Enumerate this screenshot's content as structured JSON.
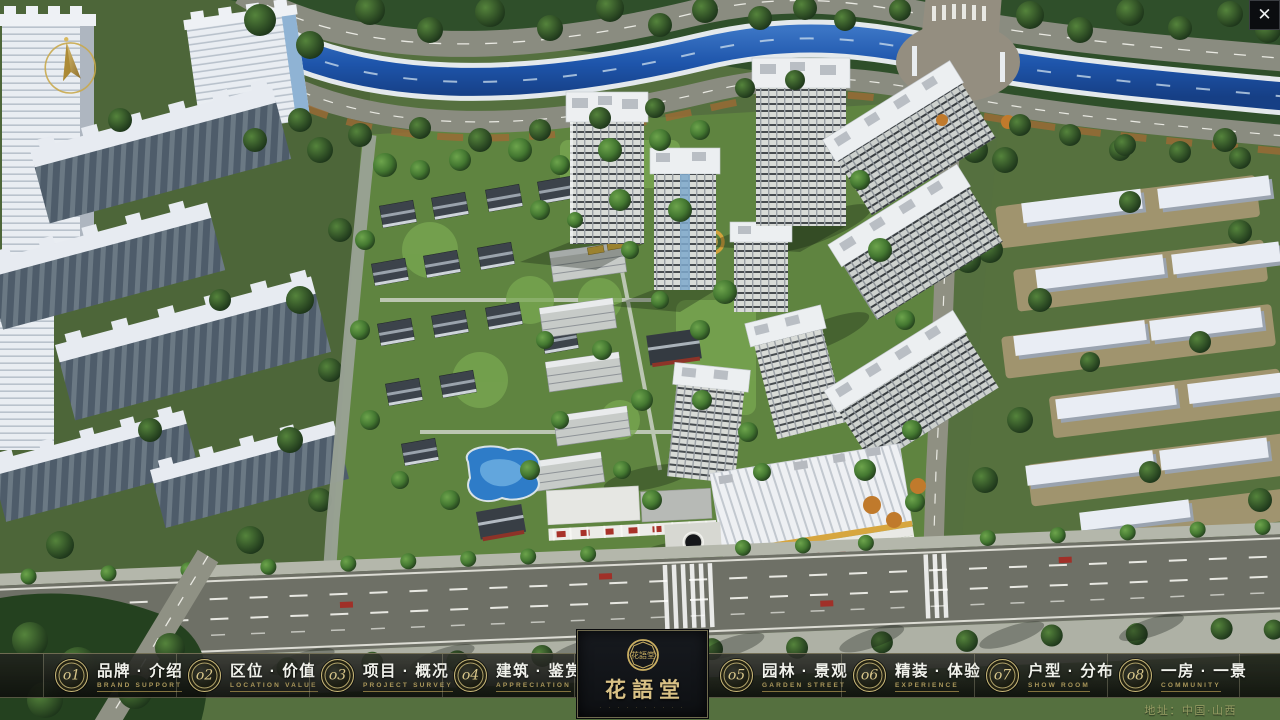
{
  "window": {
    "close_glyph": "✕"
  },
  "nav": {
    "items": [
      {
        "num": "o1",
        "label": "品牌 · 介绍",
        "sublabel": "BRAND SUPPORT"
      },
      {
        "num": "o2",
        "label": "区位 · 价值",
        "sublabel": "LOCATION VALUE"
      },
      {
        "num": "o3",
        "label": "项目 · 概况",
        "sublabel": "PROJECT SURVEY"
      },
      {
        "num": "o4",
        "label": "建筑 · 鉴赏",
        "sublabel": "APPRECIATION"
      },
      {
        "num": "o5",
        "label": "园林 · 景观",
        "sublabel": "GARDEN STREET"
      },
      {
        "num": "o6",
        "label": "精装 · 体验",
        "sublabel": "EXPERIENCE"
      },
      {
        "num": "o7",
        "label": "户型 · 分布",
        "sublabel": "SHOW ROOM"
      },
      {
        "num": "o8",
        "label": "一房 · 一景",
        "sublabel": "COMMUNITY"
      }
    ]
  },
  "logo": {
    "name": "花語堂",
    "seal": "花語堂",
    "subtext": "· · · · · · · · · ·"
  },
  "footer": {
    "address": "地址：中国·山西"
  },
  "colors": {
    "accent_gold": "#c9b878",
    "nav_text": "#f1f2ec",
    "nav_subtext": "#ab985b",
    "address_text": "#9aa066",
    "river_blue": "#1e55ab",
    "panel_bg": "#121419"
  }
}
